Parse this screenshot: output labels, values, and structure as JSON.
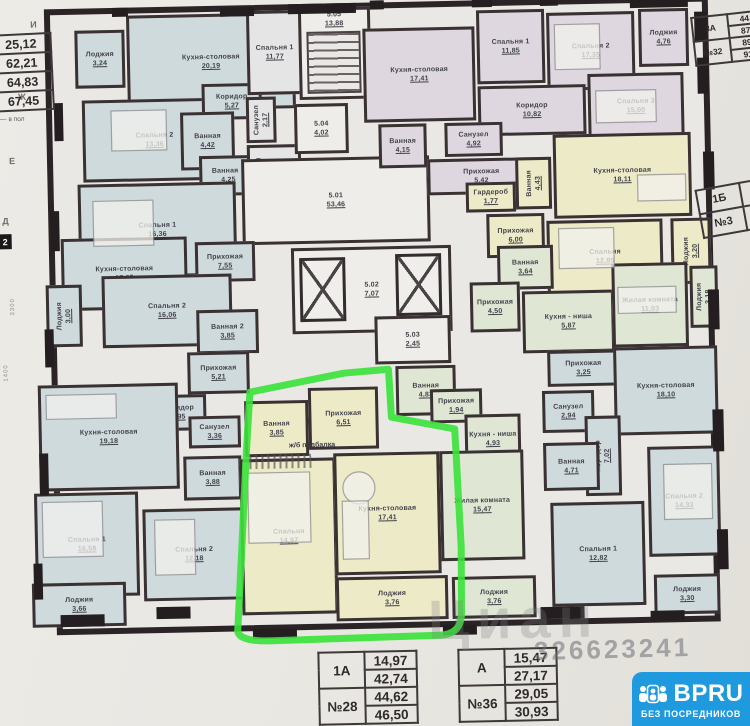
{
  "plan": {
    "beam_note": "ж/б подбалка",
    "axis_box": "2",
    "grid_letters": [
      {
        "t": "И",
        "x": 36,
        "y": 12
      },
      {
        "t": "Ж",
        "x": 22,
        "y": 84
      },
      {
        "t": "Е",
        "x": 12,
        "y": 148
      },
      {
        "t": "Д",
        "x": 4,
        "y": 208
      }
    ],
    "dimensions": [
      {
        "t": "3300",
        "x": 10,
        "y": 290
      },
      {
        "t": "1400",
        "x": 2,
        "y": 356
      }
    ],
    "wall_segments": [
      [
        118,
        2,
        16,
        9
      ],
      [
        226,
        4,
        34,
        9
      ],
      [
        294,
        2,
        68,
        10
      ],
      [
        376,
        0,
        14,
        9
      ],
      [
        478,
        0,
        20,
        9
      ],
      [
        546,
        0,
        18,
        9
      ],
      [
        636,
        2,
        58,
        11
      ],
      [
        700,
        18,
        12,
        30
      ],
      [
        58,
        96,
        9,
        38
      ],
      [
        52,
        204,
        9,
        40
      ],
      [
        44,
        322,
        9,
        38
      ],
      [
        36,
        446,
        9,
        42
      ],
      [
        28,
        556,
        9,
        36
      ],
      [
        54,
        608,
        44,
        12
      ],
      [
        150,
        602,
        34,
        12
      ],
      [
        246,
        626,
        44,
        10
      ],
      [
        436,
        626,
        34,
        10
      ],
      [
        534,
        610,
        44,
        12
      ],
      [
        644,
        616,
        34,
        10
      ],
      [
        702,
        64,
        11,
        36
      ],
      [
        706,
        158,
        11,
        38
      ],
      [
        708,
        296,
        11,
        40
      ],
      [
        710,
        416,
        11,
        42
      ],
      [
        712,
        536,
        11,
        40
      ]
    ],
    "rooms": [
      {
        "name": "Лоджия",
        "area": "3,24",
        "rect": [
          80,
          24,
          50,
          58
        ],
        "color": "blue"
      },
      {
        "name": "Кухня-столовая",
        "area": "20,19",
        "rect": [
          132,
          10,
          168,
          96
        ],
        "color": "blue"
      },
      {
        "name": "Спальня 2",
        "area": "13,36",
        "rect": [
          86,
          94,
          144,
          82
        ],
        "color": "blue"
      },
      {
        "name": "Коридор",
        "area": "5,27",
        "rect": [
          206,
          80,
          60,
          36
        ],
        "color": "blue"
      },
      {
        "name": "Ванная",
        "area": "4,42",
        "rect": [
          184,
          108,
          54,
          58
        ],
        "color": "blue"
      },
      {
        "name": "Ванная 1",
        "area": "4,25",
        "rect": [
          202,
          152,
          58,
          40
        ],
        "color": "blue"
      },
      {
        "name": "Спальня 1",
        "area": "16,36",
        "rect": [
          80,
          178,
          158,
          94
        ],
        "color": "blue"
      },
      {
        "name": "Спальня 1",
        "area": "11,77",
        "rect": [
          252,
          8,
          56,
          84
        ],
        "color": "gray"
      },
      {
        "name": "Санузел",
        "area": "2,17",
        "rect": [
          250,
          94,
          30,
          46
        ],
        "color": "gray",
        "vert": true
      },
      {
        "name": "Прихожая",
        "area": "4,84",
        "rect": [
          250,
          142,
          54,
          42
        ],
        "color": "gray"
      },
      {
        "name": "5.05",
        "area": "13,88",
        "rect": [
          304,
          6,
          72,
          92
        ],
        "color": "white",
        "top": true
      },
      {
        "name": "5.04",
        "area": "4,02",
        "rect": [
          298,
          102,
          54,
          50
        ],
        "color": "white"
      },
      {
        "name": "5.01",
        "area": "53,46",
        "rect": [
          244,
          156,
          188,
          86
        ],
        "color": "white"
      },
      {
        "name": "5.02",
        "area": "7,07",
        "rect": [
          292,
          246,
          160,
          86
        ],
        "color": "white"
      },
      {
        "name": "5.03",
        "area": "2,45",
        "rect": [
          374,
          316,
          76,
          48
        ],
        "color": "white"
      },
      {
        "name": "Кухня-столовая",
        "area": "17,41",
        "rect": [
          368,
          28,
          112,
          94
        ],
        "color": "purple"
      },
      {
        "name": "Спальня 1",
        "area": "11,85",
        "rect": [
          482,
          12,
          68,
          74
        ],
        "color": "purple"
      },
      {
        "name": "Спальня 2",
        "area": "17,35",
        "rect": [
          552,
          16,
          88,
          78
        ],
        "color": "purple"
      },
      {
        "name": "Спальня 3",
        "area": "15,00",
        "rect": [
          592,
          78,
          96,
          66
        ],
        "color": "purple"
      },
      {
        "name": "Лоджия",
        "area": "4,76",
        "rect": [
          644,
          14,
          50,
          58
        ],
        "color": "purple"
      },
      {
        "name": "Коридор",
        "area": "10,82",
        "rect": [
          482,
          88,
          108,
          50
        ],
        "color": "purple"
      },
      {
        "name": "Ванная",
        "area": "4,15",
        "rect": [
          382,
          124,
          48,
          44
        ],
        "color": "purple"
      },
      {
        "name": "Санузел",
        "area": "4,92",
        "rect": [
          448,
          124,
          58,
          34
        ],
        "color": "purple"
      },
      {
        "name": "Прихожая",
        "area": "5,42",
        "rect": [
          430,
          160,
          108,
          36
        ],
        "color": "purple"
      },
      {
        "name": "Гардероб",
        "area": "1,77",
        "rect": [
          468,
          184,
          50,
          30
        ],
        "color": "yellow"
      },
      {
        "name": "Прихожая",
        "area": "6,00",
        "rect": [
          488,
          216,
          58,
          44
        ],
        "color": "yellow"
      },
      {
        "name": "Ванная",
        "area": "4,43",
        "rect": [
          518,
          160,
          36,
          52
        ],
        "color": "yellow",
        "vert": true
      },
      {
        "name": "Кухня-столовая",
        "area": "18,11",
        "rect": [
          556,
          138,
          138,
          84
        ],
        "color": "yellow"
      },
      {
        "name": "Спальня",
        "area": "12,85",
        "rect": [
          548,
          224,
          116,
          74
        ],
        "color": "yellow"
      },
      {
        "name": "Лоджия",
        "area": "3,20",
        "rect": [
          672,
          224,
          40,
          66
        ],
        "color": "yellow",
        "vert": true
      },
      {
        "name": "Ванная",
        "area": "3,64",
        "rect": [
          498,
          248,
          56,
          44
        ],
        "color": "green"
      },
      {
        "name": "Прихожая",
        "area": "4,50",
        "rect": [
          470,
          284,
          50,
          50
        ],
        "color": "green"
      },
      {
        "name": "Кухня - ниша",
        "area": "5,87",
        "rect": [
          522,
          294,
          92,
          62
        ],
        "color": "green"
      },
      {
        "name": "Жилая комната",
        "area": "11,03",
        "rect": [
          612,
          268,
          76,
          84
        ],
        "color": "green"
      },
      {
        "name": "Лоджия",
        "area": "3,18",
        "rect": [
          690,
          272,
          28,
          62
        ],
        "color": "green",
        "vert": true
      },
      {
        "name": "Прихожая",
        "area": "3,25",
        "rect": [
          546,
          354,
          72,
          36
        ],
        "color": "blue"
      },
      {
        "name": "Кухня-столовая",
        "area": "18,10",
        "rect": [
          612,
          352,
          104,
          88
        ],
        "color": "blue"
      },
      {
        "name": "Санузел",
        "area": "2,94",
        "rect": [
          540,
          394,
          52,
          42
        ],
        "color": "blue"
      },
      {
        "name": "Коридор",
        "area": "7,02",
        "rect": [
          582,
          420,
          36,
          80
        ],
        "color": "blue",
        "vert": true
      },
      {
        "name": "Ванная",
        "area": "4,71",
        "rect": [
          540,
          446,
          56,
          48
        ],
        "color": "blue"
      },
      {
        "name": "Спальня 1",
        "area": "12,82",
        "rect": [
          546,
          506,
          94,
          104
        ],
        "color": "blue"
      },
      {
        "name": "Спальня 2",
        "area": "14,33",
        "rect": [
          644,
          452,
          72,
          110
        ],
        "color": "blue"
      },
      {
        "name": "Лоджия",
        "area": "3,30",
        "rect": [
          648,
          580,
          66,
          40
        ],
        "color": "blue"
      },
      {
        "name": "Кухня-столовая",
        "area": "17,25",
        "rect": [
          62,
          232,
          126,
          72
        ],
        "color": "blue"
      },
      {
        "name": "Прихожая",
        "area": "7,55",
        "rect": [
          196,
          238,
          60,
          40
        ],
        "color": "blue"
      },
      {
        "name": "Спальня 2",
        "area": "16,06",
        "rect": [
          102,
          270,
          130,
          72
        ],
        "color": "blue"
      },
      {
        "name": "Лоджия",
        "area": "3,00",
        "rect": [
          46,
          278,
          36,
          62
        ],
        "color": "blue",
        "vert": true
      },
      {
        "name": "Ванная 2",
        "area": "3,85",
        "rect": [
          196,
          306,
          62,
          44
        ],
        "color": "blue"
      },
      {
        "name": "Прихожая",
        "area": "5,21",
        "rect": [
          186,
          348,
          62,
          42
        ],
        "color": "blue"
      },
      {
        "name": "Коридор",
        "area": "4,95",
        "rect": [
          148,
          390,
          56,
          36
        ],
        "color": "blue"
      },
      {
        "name": "Кухня-столовая",
        "area": "19,18",
        "rect": [
          36,
          378,
          140,
          106
        ],
        "color": "blue"
      },
      {
        "name": "Санузел",
        "area": "3,36",
        "rect": [
          186,
          412,
          52,
          32
        ],
        "color": "blue"
      },
      {
        "name": "Ванная",
        "area": "3,88",
        "rect": [
          180,
          452,
          58,
          44
        ],
        "color": "blue"
      },
      {
        "name": "Спальня 1",
        "area": "16,58",
        "rect": [
          30,
          486,
          104,
          104
        ],
        "color": "blue"
      },
      {
        "name": "Спальня 2",
        "area": "12,18",
        "rect": [
          138,
          504,
          102,
          92
        ],
        "color": "blue"
      },
      {
        "name": "Лоджия",
        "area": "3,66",
        "rect": [
          26,
          576,
          94,
          44
        ],
        "color": "blue"
      },
      {
        "name": "Ванная",
        "area": "3,85",
        "rect": [
          242,
          398,
          64,
          56
        ],
        "color": "yellow"
      },
      {
        "name": "Прихожая",
        "area": "6,51",
        "rect": [
          306,
          386,
          70,
          62
        ],
        "color": "yellow"
      },
      {
        "name": "Спальня",
        "area": "14,97",
        "rect": [
          236,
          456,
          96,
          156
        ],
        "color": "yellow"
      },
      {
        "name": "Кухня-столовая",
        "area": "17,41",
        "rect": [
          330,
          452,
          106,
          122
        ],
        "color": "yellow"
      },
      {
        "name": "Лоджия",
        "area": "3,76",
        "rect": [
          330,
          576,
          112,
          44
        ],
        "color": "yellow"
      },
      {
        "name": "Ванная",
        "area": "4,83",
        "rect": [
          394,
          366,
          60,
          50
        ],
        "color": "green"
      },
      {
        "name": "Прихожая",
        "area": "1,94",
        "rect": [
          428,
          390,
          52,
          34
        ],
        "color": "green"
      },
      {
        "name": "Кухня - ниша",
        "area": "4,93",
        "rect": [
          462,
          416,
          56,
          50
        ],
        "color": "green"
      },
      {
        "name": "Жилая комната",
        "area": "15,47",
        "rect": [
          436,
          452,
          84,
          110
        ],
        "color": "green"
      },
      {
        "name": "Лоджия",
        "area": "3,76",
        "rect": [
          446,
          578,
          84,
          42
        ],
        "color": "green"
      }
    ]
  },
  "tables": {
    "top_left": {
      "col1": [
        "1А",
        "№2"
      ],
      "values": [
        "25,12",
        "62,21",
        "64,83",
        "67,45"
      ],
      "note": "— в пол"
    },
    "top_right": {
      "type": "3А",
      "number": "№32",
      "values": [
        "44,",
        "87,",
        "89,",
        "91,"
      ]
    },
    "right_mid": {
      "type": "1Б",
      "number": "№3"
    },
    "bottom_left": {
      "type": "1А",
      "number": "№28",
      "values": [
        "14,97",
        "42,74",
        "44,62",
        "46,50"
      ]
    },
    "bottom_right": {
      "type": "А",
      "number": "№36",
      "values": [
        "15,47",
        "27,17",
        "29,05",
        "30,93"
      ]
    }
  },
  "watermarks": {
    "brand": "Циан",
    "id_number": "326623241"
  },
  "logo": {
    "brand": "BPRU",
    "tagline": "БЕЗ ПОСРЕДНИКОВ"
  }
}
